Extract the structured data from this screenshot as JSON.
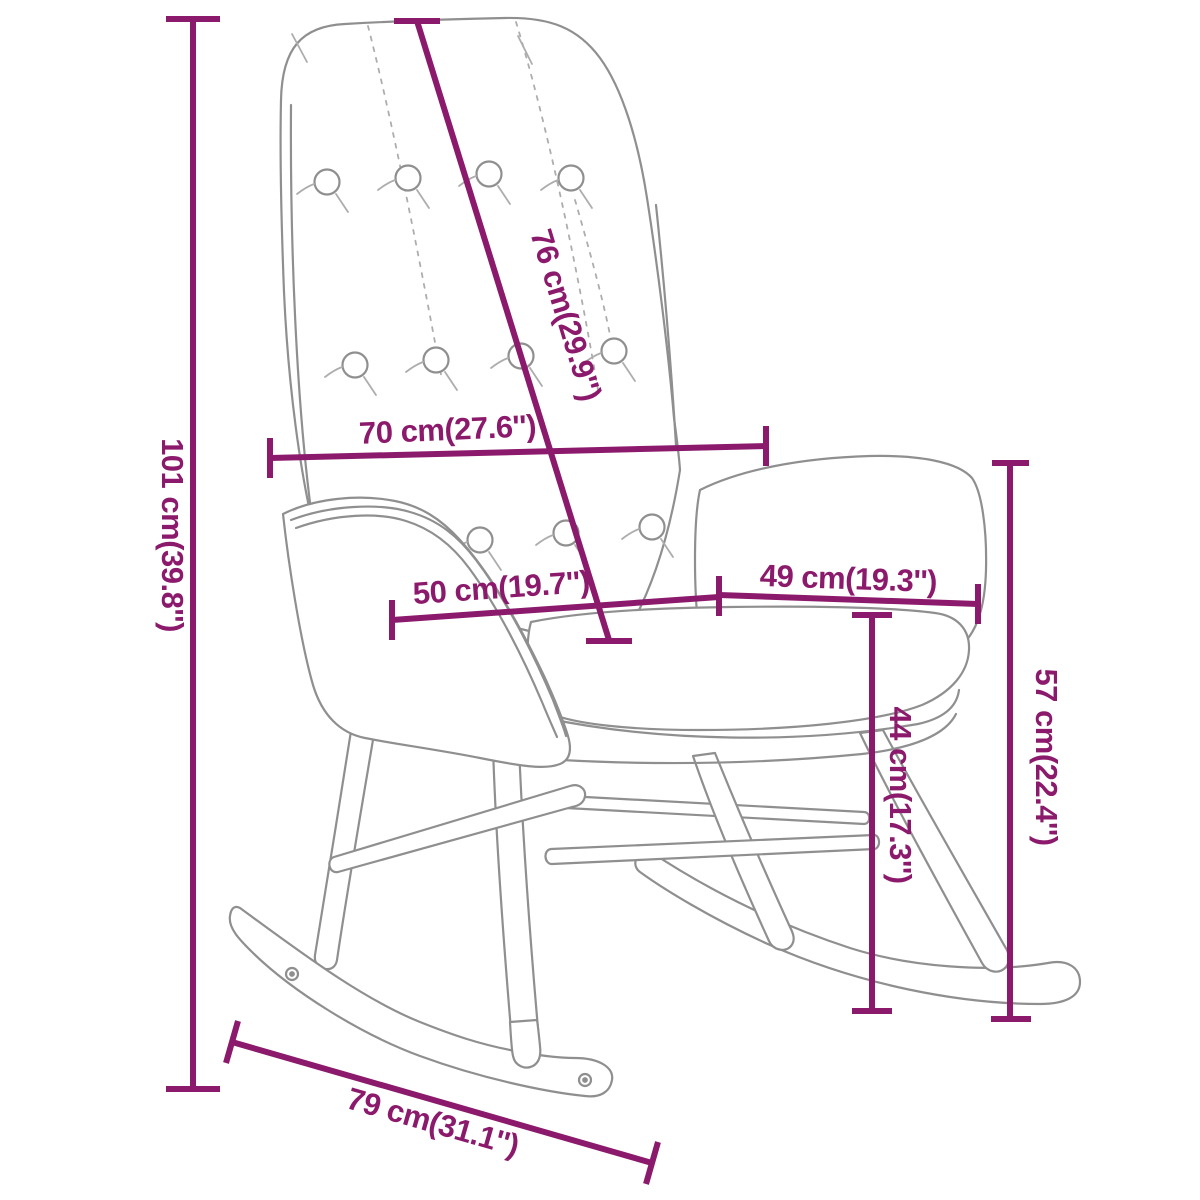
{
  "diagram": {
    "title": "rocking-chair-dimension-diagram",
    "accent_color": "#8c1a6c",
    "outline_color": "#8f8f8f",
    "detail_color": "#adadad",
    "background_color": "#ffffff",
    "measurements": [
      {
        "id": "overall-height",
        "label": "101 cm(39.8'')",
        "orientation": "vertical-left"
      },
      {
        "id": "backrest-diagonal",
        "label": "76 cm(29.9'')",
        "orientation": "diagonal-backrest"
      },
      {
        "id": "backrest-width",
        "label": "70 cm(27.6'')",
        "orientation": "horizontal-backrest"
      },
      {
        "id": "seat-width",
        "label": "50 cm(19.7'')",
        "orientation": "horizontal-seat"
      },
      {
        "id": "armrest-span",
        "label": "49 cm(19.3'')",
        "orientation": "horizontal-armrest"
      },
      {
        "id": "armrest-height",
        "label": "57 cm(22.4'')",
        "orientation": "vertical-right"
      },
      {
        "id": "seat-height",
        "label": "44 cm(17.3'')",
        "orientation": "vertical-middle"
      },
      {
        "id": "rocker-length",
        "label": "79 cm(31.1'')",
        "orientation": "diagonal-rocker"
      }
    ]
  }
}
